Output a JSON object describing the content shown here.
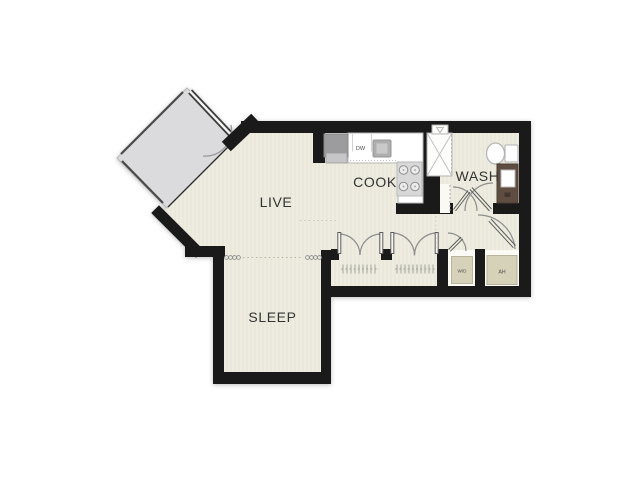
{
  "plan_title": "Studio apartment floor plan",
  "rooms": {
    "live": {
      "label": "LIVE"
    },
    "cook": {
      "label": "COOK"
    },
    "wash": {
      "label": "WASH"
    },
    "sleep": {
      "label": "SLEEP"
    }
  },
  "fixtures": {
    "dishwasher": {
      "label": "DW"
    },
    "washer_dryer": {
      "label": "W/D"
    },
    "air_handler": {
      "label": "AH"
    }
  },
  "colors": {
    "background": "#ffffff",
    "wall": "#1a1a1a",
    "floor": "#edecdf",
    "floor_stripe": "#e7e5d8",
    "balcony": "#dbdbde",
    "counter": "#ffffff",
    "appliance_gray": "#9c9c9f",
    "closet_box": "#d6d2b9",
    "vanity": "#5f4d42",
    "label_text": "#333333"
  }
}
